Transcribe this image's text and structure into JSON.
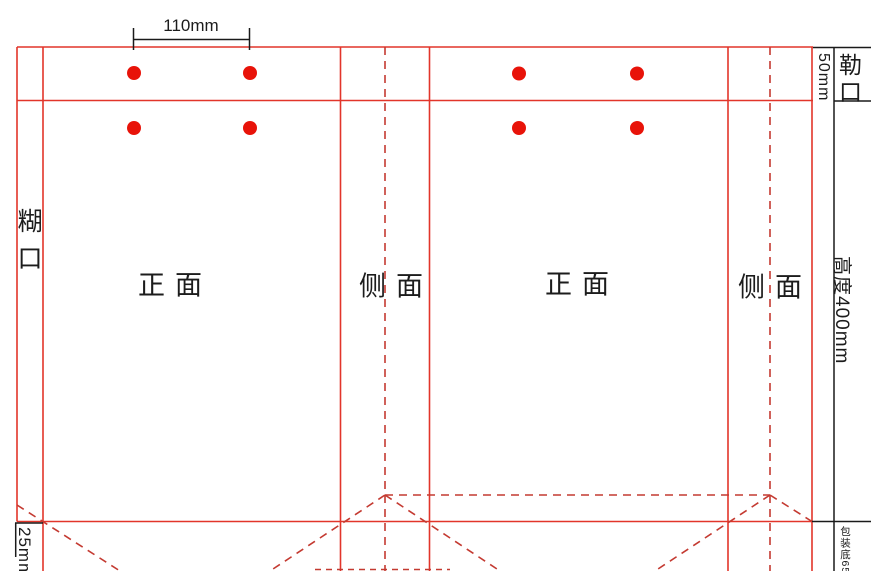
{
  "colors": {
    "cut_line_red": "#e2352a",
    "fold_line_red": "#c43a31",
    "hole_dot_red": "#e81309",
    "dimension_black": "#1a1a1a"
  },
  "dimension_labels": {
    "hole_spacing": "110mm",
    "cuff_width": "50mm",
    "height": "高度400mm",
    "bottom_fold": "25mm",
    "bottom_note": "包装底65"
  },
  "panel_labels": {
    "glue_flap": "糊口",
    "top_cuff": "勒口",
    "front_1": "正面",
    "side_1": "侧面",
    "front_2": "正面",
    "side_2": "侧面"
  }
}
